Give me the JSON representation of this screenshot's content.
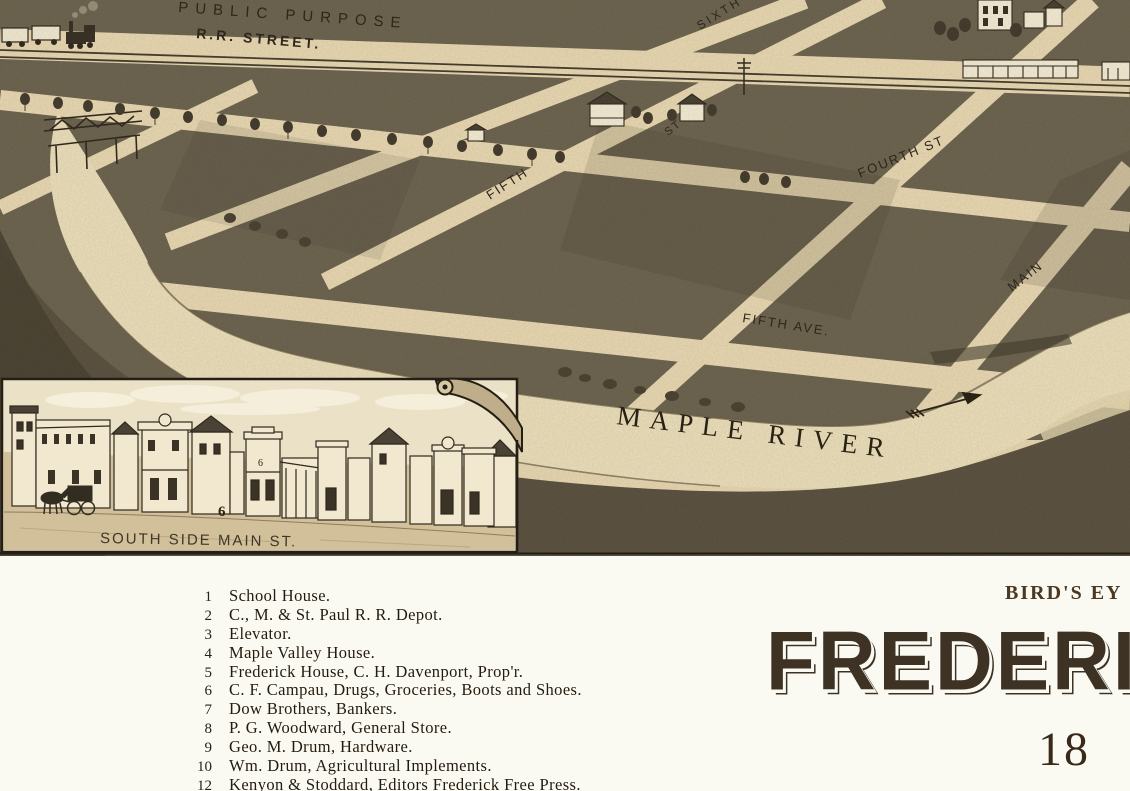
{
  "map": {
    "labels": {
      "public_purpose": "PUBLIC PURPOSE",
      "rr_street": "R.R. STREET.",
      "sixth": "SIXTH",
      "st_short": "ST",
      "fifth": "FIFTH",
      "fourth_st": "FOURTH ST",
      "main": "MAIN",
      "fifth_ave": "FIFTH AVE.",
      "maple_river": "MAPLE RIVER"
    },
    "inset": {
      "caption": "SOUTH SIDE MAIN ST.",
      "number_street": "6",
      "number_facade": "6"
    },
    "colors": {
      "paper": "#e7d8b2",
      "block_dark": "#6e6551",
      "river_light": "#ecdfbc",
      "bank_dark": "#5c5342",
      "west_hill": "#4b4433",
      "ink": "#2e271b",
      "page_white": "#fbfaf2",
      "title_brown": "#3e3225"
    }
  },
  "legend": {
    "items": [
      {
        "num": "1",
        "text": "School House."
      },
      {
        "num": "2",
        "text": "C., M. & St. Paul R. R. Depot."
      },
      {
        "num": "3",
        "text": "Elevator."
      },
      {
        "num": "4",
        "text": "Maple Valley House."
      },
      {
        "num": "5",
        "text": "Frederick House, C. H. Davenport, Prop'r."
      },
      {
        "num": "6",
        "text": "C. F. Campau, Drugs, Groceries, Boots and Shoes."
      },
      {
        "num": "7",
        "text": "Dow Brothers, Bankers."
      },
      {
        "num": "8",
        "text": "P. G. Woodward, General Store."
      },
      {
        "num": "9",
        "text": "Geo. M. Drum, Hardware."
      },
      {
        "num": "10",
        "text": "Wm. Drum, Agricultural Implements."
      },
      {
        "num": "12",
        "text": "Kenyon & Stoddard, Editors Frederick Free Press."
      }
    ]
  },
  "title": {
    "kicker": "BIRD'S EY",
    "main": "FREDERIC",
    "year": "18"
  }
}
